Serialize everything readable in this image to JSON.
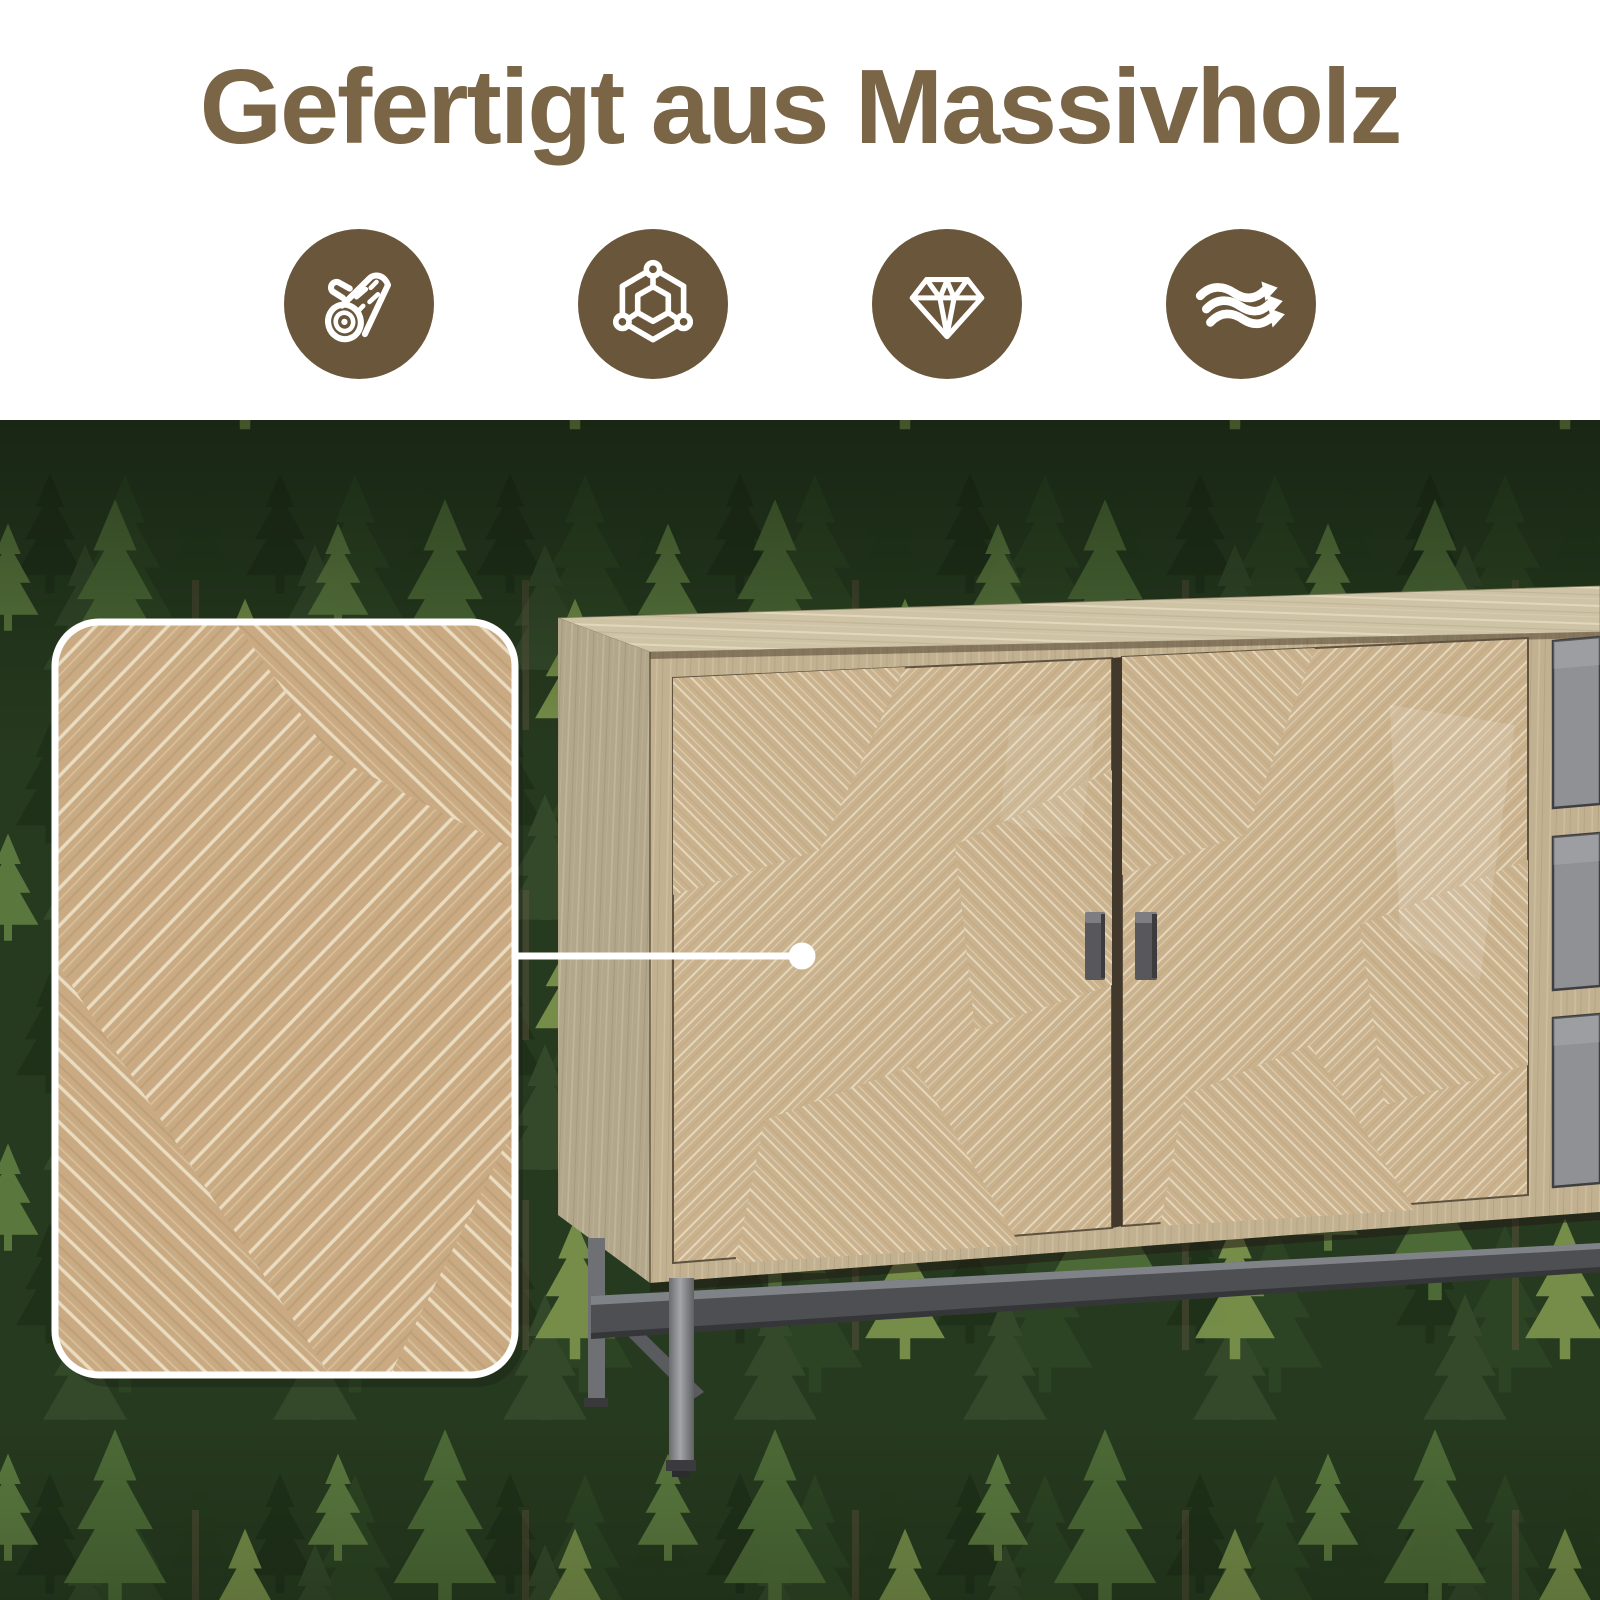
{
  "header": {
    "title": "Gefertigt aus Massivholz"
  },
  "feature_icons": [
    {
      "name": "log-icon"
    },
    {
      "name": "wood-structure-icon"
    },
    {
      "name": "diamond-icon"
    },
    {
      "name": "airflow-icon"
    }
  ],
  "colors": {
    "title_text": "#7b6547",
    "icon_circle": "#6a563a",
    "icon_glyph": "#ffffff",
    "forest_base": "#263a1f",
    "wood_top": "#cfc3a6",
    "wood_side": "#b2a68b",
    "wood_frame": "#c2b191",
    "wood_door": "#c9b28d",
    "grain_streak": "#efe4cd",
    "inset_wood": "#c9aa82",
    "drawer_front": "#8f9194",
    "handle_metal": "#58585c",
    "leg_metal": "#6f7073",
    "stretcher_metal": "#4e4f52",
    "callout": "#ffffff"
  }
}
